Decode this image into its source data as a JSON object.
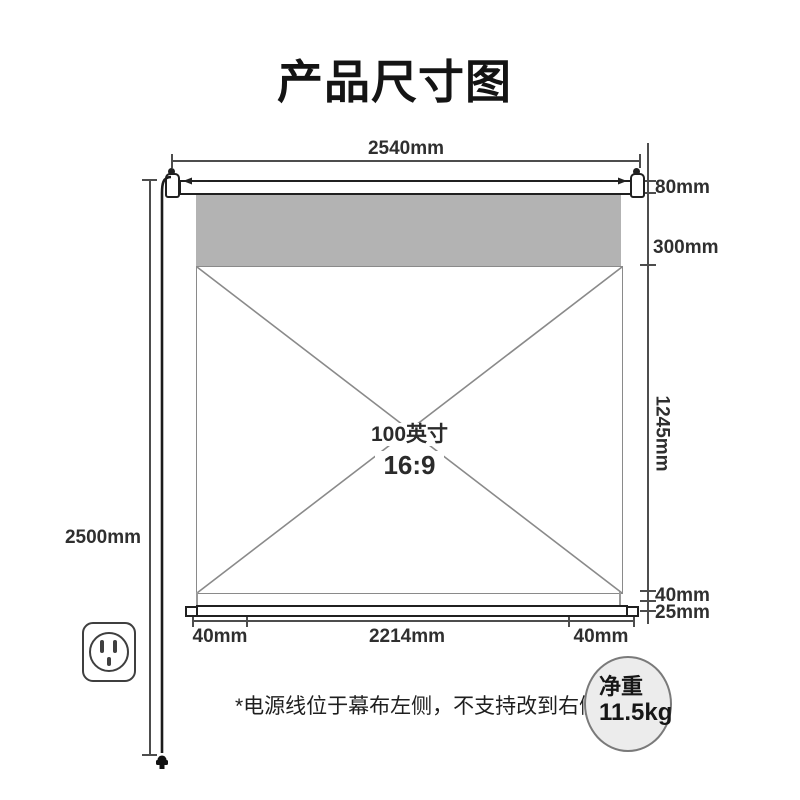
{
  "title": "产品尺寸图",
  "dims": {
    "top_width": "2540mm",
    "case_height": "80mm",
    "top_black_drop": "300mm",
    "view_height": "1245mm",
    "total_height": "2500mm",
    "bottom_drop": "40mm",
    "bottom_bar_height": "25mm",
    "bottom_left_margin": "40mm",
    "view_width": "2214mm",
    "bottom_right_margin": "40mm"
  },
  "screen": {
    "size": "100英寸",
    "ratio": "16:9"
  },
  "footnote": "*电源线位于幕布左侧，不支持改到右侧",
  "weight": {
    "label": "净重",
    "value": "11.5kg"
  },
  "icons": {
    "outlet": "power-outlet-icon",
    "plug": "power-plug-icon",
    "cord": "power-cord"
  },
  "colors": {
    "fabric_gray": "#b3b3b3",
    "line_dark": "#202020",
    "dim_line": "#4d4d4d",
    "badge_fill": "#ececec",
    "background": "#ffffff"
  }
}
